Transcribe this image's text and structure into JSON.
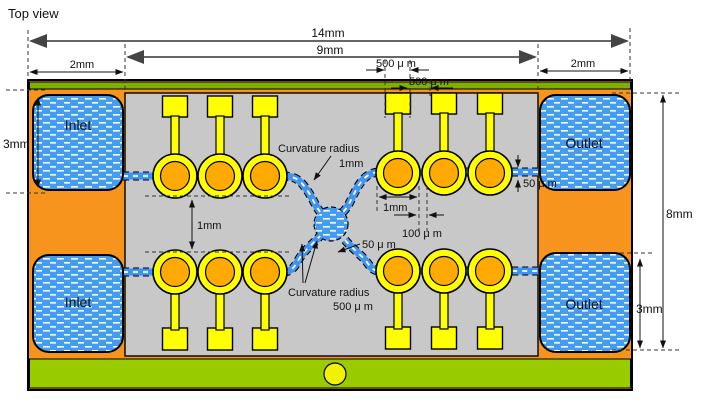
{
  "title": "Top view",
  "device": {
    "inlet_top_label": "Inlet",
    "inlet_bottom_label": "Inlet",
    "outlet_top_label": "Outlet",
    "outlet_bottom_label": "Outlet"
  },
  "dimensions": {
    "total_width": "14mm",
    "chamber_width": "9mm",
    "margin_left": "2mm",
    "margin_right": "2mm",
    "pad_width": "500 μ m",
    "pad_gap": "500 μ m",
    "inlet_height": "3mm",
    "row_gap": "1mm",
    "electrode_pitch": "1mm",
    "electrode_gap": "100 μ m",
    "channel_width_center": "50 μ m",
    "channel_width_right": "50 μ m",
    "chamber_height": "8mm",
    "outlet_height": "3mm"
  },
  "annotations": {
    "curvature_top_line1": "Curvature radius",
    "curvature_top_line2": "1mm",
    "curvature_bottom_line1": "Curvature radius",
    "curvature_bottom_line2": "500 μ m"
  },
  "colors": {
    "body_orange": "#F7941E",
    "chamber_gray": "#C8C8C8",
    "reservoir_blue": "#459BF0",
    "channel_blue": "#3F93F2",
    "electrode_yellow": "#FFFF00",
    "electrode_core_orange": "#FFAA00",
    "glass_green_top": "#7EB000",
    "base_green_bottom": "#99CC00"
  }
}
